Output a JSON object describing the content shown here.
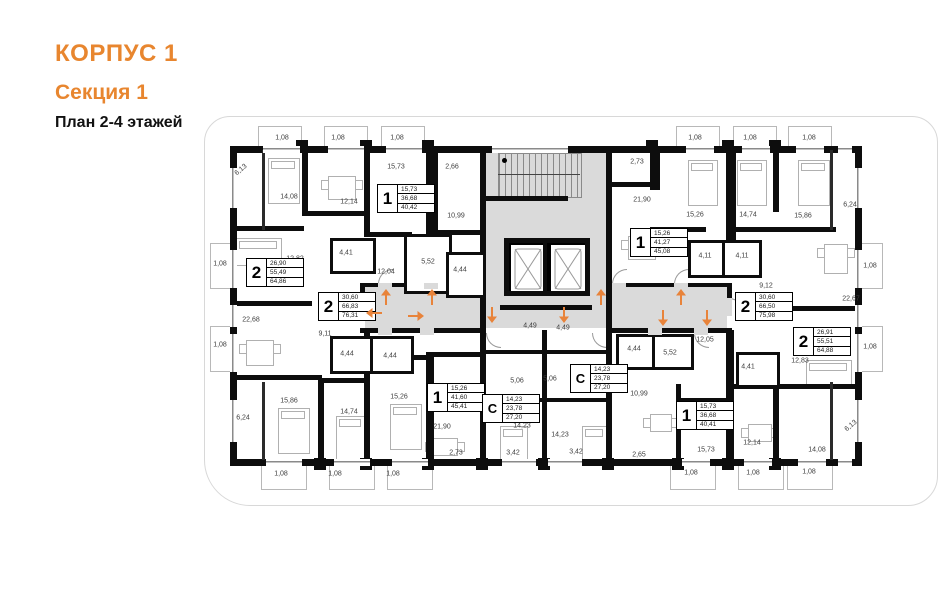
{
  "title": {
    "building": "КОРПУС 1",
    "section": "Секция 1",
    "plan": "План 2-4 этажей"
  },
  "colors": {
    "accent": "#E8862F",
    "arrow": "#E8833A",
    "corridor": "#DADADA",
    "wall": "#0D0D0D"
  },
  "apartments": [
    {
      "id": "apt-2-top-left",
      "type": "2",
      "living": "26,90",
      "area": "55,49",
      "total": "64,86",
      "x": 246,
      "y": 258
    },
    {
      "id": "apt-2-left",
      "type": "2",
      "living": "30,60",
      "area": "66,83",
      "total": "76,31",
      "x": 318,
      "y": 292
    },
    {
      "id": "apt-1-top",
      "type": "1",
      "living": "15,73",
      "area": "36,68",
      "total": "40,42",
      "x": 377,
      "y": 184
    },
    {
      "id": "apt-1-center-right",
      "type": "1",
      "living": "15,26",
      "area": "41,27",
      "total": "45,08",
      "x": 630,
      "y": 228
    },
    {
      "id": "apt-2-right",
      "type": "2",
      "living": "30,60",
      "area": "66,50",
      "total": "75,98",
      "x": 735,
      "y": 292
    },
    {
      "id": "apt-2-bottom-right",
      "type": "2",
      "living": "26,91",
      "area": "55,51",
      "total": "64,88",
      "x": 793,
      "y": 327
    },
    {
      "id": "apt-1-bottom-left",
      "type": "1",
      "living": "15,26",
      "area": "41,60",
      "total": "45,41",
      "x": 427,
      "y": 383
    },
    {
      "id": "studio-left",
      "type": "С",
      "living": "14,23",
      "area": "23,78",
      "total": "27,20",
      "x": 482,
      "y": 394
    },
    {
      "id": "studio-right",
      "type": "С",
      "living": "14,23",
      "area": "23,78",
      "total": "27,20",
      "x": 570,
      "y": 364
    },
    {
      "id": "apt-1-bottom-right",
      "type": "1",
      "living": "15,73",
      "area": "36,68",
      "total": "40,41",
      "x": 676,
      "y": 401
    }
  ],
  "room_labels": [
    {
      "t": "6,13",
      "x": 241,
      "y": 170,
      "r": -40
    },
    {
      "t": "14,08",
      "x": 289,
      "y": 197
    },
    {
      "t": "12,14",
      "x": 349,
      "y": 202
    },
    {
      "t": "15,73",
      "x": 396,
      "y": 167
    },
    {
      "t": "2,66",
      "x": 452,
      "y": 167
    },
    {
      "t": "10,99",
      "x": 456,
      "y": 216
    },
    {
      "t": "2,73",
      "x": 637,
      "y": 162
    },
    {
      "t": "21,90",
      "x": 642,
      "y": 200
    },
    {
      "t": "15,26",
      "x": 695,
      "y": 215
    },
    {
      "t": "14,74",
      "x": 748,
      "y": 215
    },
    {
      "t": "15,86",
      "x": 803,
      "y": 216
    },
    {
      "t": "6,24",
      "x": 850,
      "y": 205
    },
    {
      "t": "12,82",
      "x": 295,
      "y": 259
    },
    {
      "t": "4,41",
      "x": 346,
      "y": 253
    },
    {
      "t": "12,04",
      "x": 386,
      "y": 272
    },
    {
      "t": "5,52",
      "x": 428,
      "y": 262
    },
    {
      "t": "4,44",
      "x": 460,
      "y": 270
    },
    {
      "t": "4,11",
      "x": 705,
      "y": 256
    },
    {
      "t": "4,11",
      "x": 742,
      "y": 256
    },
    {
      "t": "9,12",
      "x": 766,
      "y": 286
    },
    {
      "t": "22,67",
      "x": 851,
      "y": 299
    },
    {
      "t": "22,68",
      "x": 251,
      "y": 320
    },
    {
      "t": "9,11",
      "x": 325,
      "y": 334
    },
    {
      "t": "4,44",
      "x": 347,
      "y": 354
    },
    {
      "t": "4,44",
      "x": 390,
      "y": 356
    },
    {
      "t": "12,05",
      "x": 705,
      "y": 340
    },
    {
      "t": "4,44",
      "x": 634,
      "y": 349
    },
    {
      "t": "5,52",
      "x": 670,
      "y": 353
    },
    {
      "t": "4,41",
      "x": 748,
      "y": 367
    },
    {
      "t": "12,83",
      "x": 800,
      "y": 361
    },
    {
      "t": "15,86",
      "x": 289,
      "y": 401
    },
    {
      "t": "14,74",
      "x": 349,
      "y": 412
    },
    {
      "t": "15,26",
      "x": 399,
      "y": 397
    },
    {
      "t": "21,90",
      "x": 442,
      "y": 427
    },
    {
      "t": "10,99",
      "x": 639,
      "y": 394
    },
    {
      "t": "6,24",
      "x": 243,
      "y": 418
    },
    {
      "t": "14,23",
      "x": 522,
      "y": 426
    },
    {
      "t": "14,23",
      "x": 560,
      "y": 435
    },
    {
      "t": "5,06",
      "x": 517,
      "y": 381
    },
    {
      "t": "5,06",
      "x": 550,
      "y": 379
    },
    {
      "t": "4,49",
      "x": 530,
      "y": 326
    },
    {
      "t": "4,49",
      "x": 563,
      "y": 328
    },
    {
      "t": "2,73",
      "x": 456,
      "y": 453
    },
    {
      "t": "3,42",
      "x": 513,
      "y": 453
    },
    {
      "t": "3,42",
      "x": 576,
      "y": 452
    },
    {
      "t": "2,65",
      "x": 639,
      "y": 455
    },
    {
      "t": "15,73",
      "x": 706,
      "y": 450
    },
    {
      "t": "12,14",
      "x": 752,
      "y": 443
    },
    {
      "t": "14,08",
      "x": 817,
      "y": 450
    },
    {
      "t": "6,13",
      "x": 851,
      "y": 426,
      "r": -40
    },
    {
      "t": "1,08",
      "x": 282,
      "y": 138
    },
    {
      "t": "1,08",
      "x": 338,
      "y": 138
    },
    {
      "t": "1,08",
      "x": 397,
      "y": 138
    },
    {
      "t": "1,08",
      "x": 695,
      "y": 138
    },
    {
      "t": "1,08",
      "x": 750,
      "y": 138
    },
    {
      "t": "1,08",
      "x": 809,
      "y": 138
    },
    {
      "t": "1,08",
      "x": 281,
      "y": 474
    },
    {
      "t": "1,08",
      "x": 335,
      "y": 474
    },
    {
      "t": "1,08",
      "x": 393,
      "y": 474
    },
    {
      "t": "1,08",
      "x": 691,
      "y": 473
    },
    {
      "t": "1,08",
      "x": 753,
      "y": 473
    },
    {
      "t": "1,08",
      "x": 809,
      "y": 472
    },
    {
      "t": "1,08",
      "x": 220,
      "y": 264
    },
    {
      "t": "1,08",
      "x": 220,
      "y": 345
    },
    {
      "t": "1,08",
      "x": 870,
      "y": 266
    },
    {
      "t": "1,08",
      "x": 870,
      "y": 347
    }
  ],
  "entrance_arrows": [
    {
      "x": 386,
      "y": 297,
      "dir": "up"
    },
    {
      "x": 432,
      "y": 297,
      "dir": "up"
    },
    {
      "x": 601,
      "y": 297,
      "dir": "up"
    },
    {
      "x": 681,
      "y": 297,
      "dir": "up"
    },
    {
      "x": 492,
      "y": 315,
      "dir": "down"
    },
    {
      "x": 564,
      "y": 315,
      "dir": "down"
    },
    {
      "x": 663,
      "y": 318,
      "dir": "down"
    },
    {
      "x": 707,
      "y": 318,
      "dir": "down"
    },
    {
      "x": 374,
      "y": 313,
      "dir": "left"
    },
    {
      "x": 416,
      "y": 316,
      "dir": "right"
    }
  ]
}
